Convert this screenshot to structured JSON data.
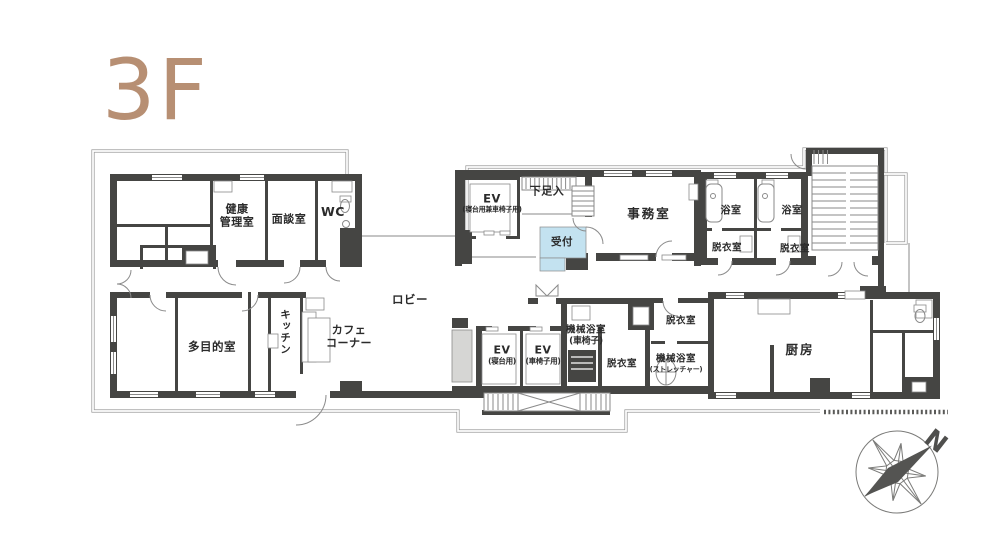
{
  "title": {
    "text": "3F",
    "color": "#b78f73"
  },
  "colors": {
    "wall": "#454543",
    "thin_line": "#8a8a8a",
    "outer_outline": "#9b9b9b",
    "reception_highlight": "#c3e2f0",
    "title_tan": "#b78f73"
  },
  "rooms": {
    "health_mgmt": {
      "label": "健康\n管理室"
    },
    "interview": {
      "label": "面談室"
    },
    "wc": {
      "label": "WC"
    },
    "multipurpose": {
      "label": "多目的室"
    },
    "kitchenette": {
      "label": "キッチン"
    },
    "cafe_corner": {
      "label": "カフェ\nコーナー"
    },
    "lobby": {
      "label": "ロビー"
    },
    "elevator_main": {
      "label": "EV",
      "sub": "(寝台用兼車椅子用)"
    },
    "shoe_storage": {
      "label": "下足入"
    },
    "reception": {
      "label": "受付"
    },
    "office": {
      "label": "事務室"
    },
    "bath_1": {
      "label": "浴室"
    },
    "bath_2": {
      "label": "浴室"
    },
    "dressing_1": {
      "label": "脱衣室"
    },
    "dressing_2": {
      "label": "脱衣室"
    },
    "elevator_bed": {
      "label": "EV",
      "sub": "(寝台用)"
    },
    "elevator_wheelchair": {
      "label": "EV",
      "sub": "(車椅子用)"
    },
    "machine_bath_wheelchair": {
      "label": "機械浴室",
      "sub": "(車椅子)"
    },
    "dressing_3": {
      "label": "脱衣室"
    },
    "dressing_4": {
      "label": "脱衣室"
    },
    "machine_bath_stretcher": {
      "label": "機械浴室",
      "sub": "(ストレッチャー)"
    },
    "kitchen_main": {
      "label": "厨房"
    }
  },
  "compass": {
    "north_label": "N"
  }
}
